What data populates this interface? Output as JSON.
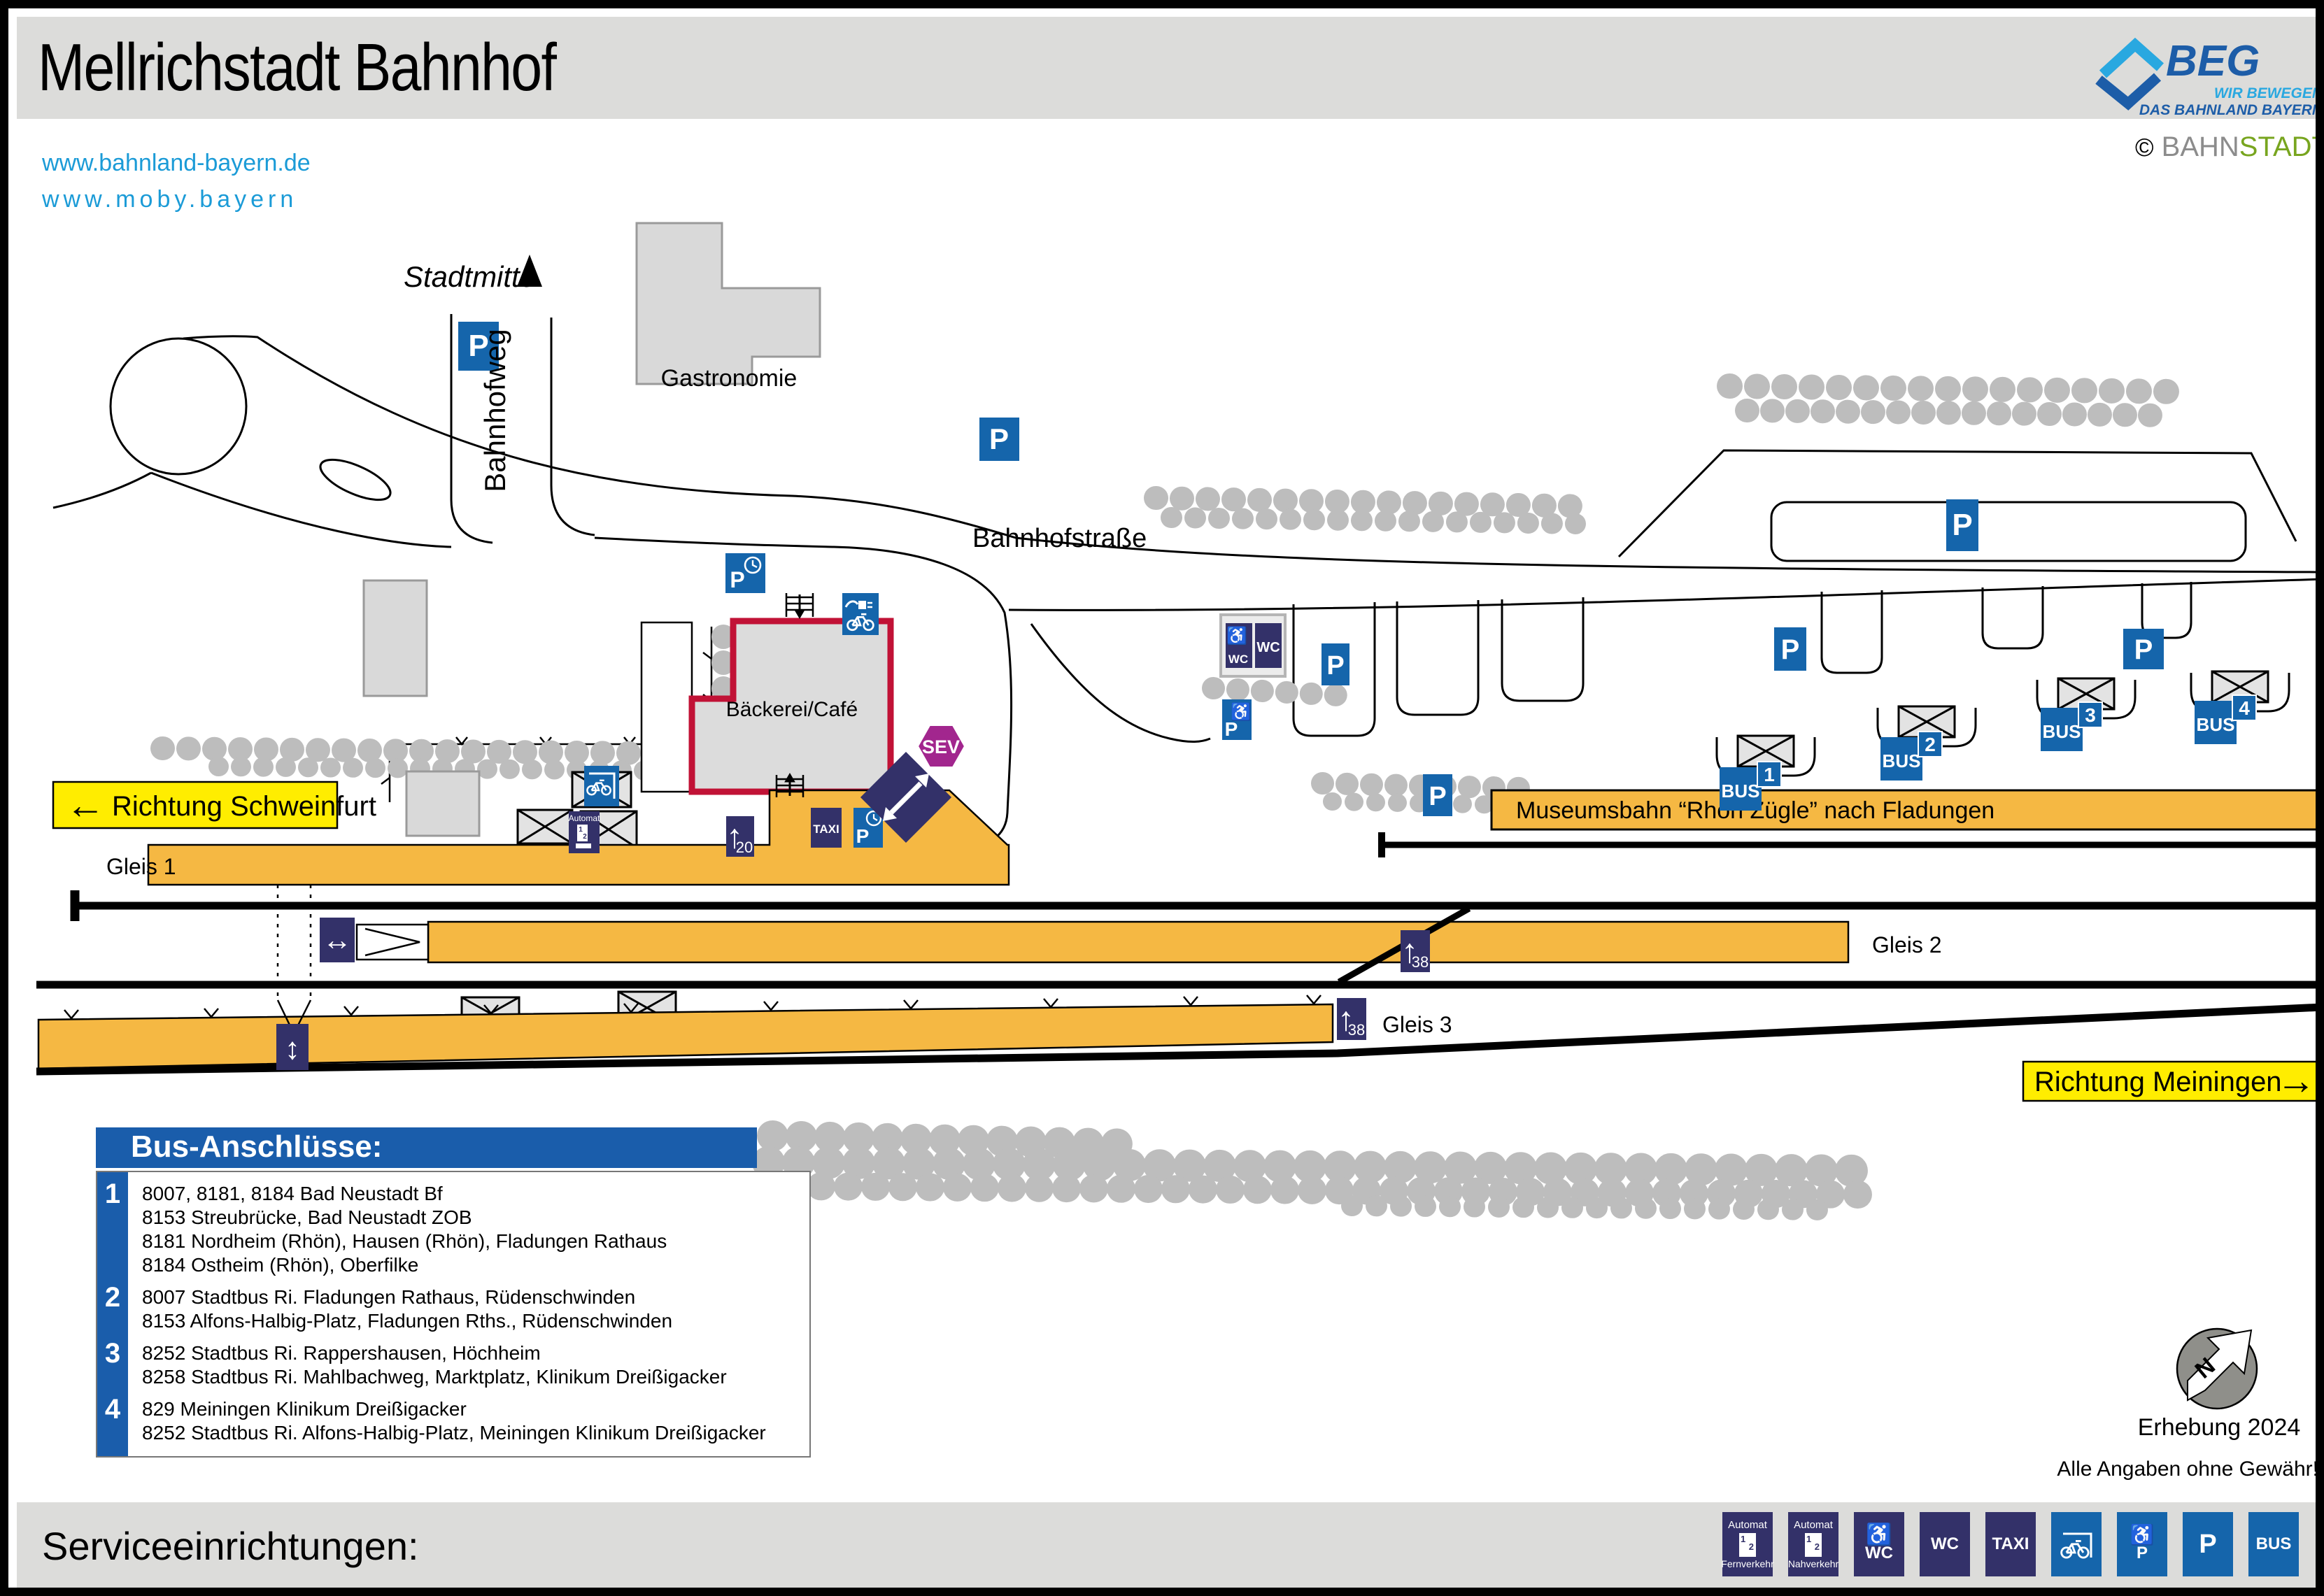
{
  "header": {
    "title": "Mellrichstadt Bahnhof",
    "links": [
      "www.bahnland-bayern.de",
      "www.moby.bayern"
    ],
    "beg": {
      "name": "BEG",
      "tagline1": "WIR BEWEGEN",
      "tagline2": "DAS BAHNLAND BAYERN"
    },
    "credit": {
      "copyright": "©",
      "part1": "BAHN",
      "part2": "STADT"
    }
  },
  "map": {
    "labels": {
      "stadtmitte": "Stadtmitte",
      "bahnhofweg": "Bahnhofweg",
      "bahnhofstrasse": "Bahnhofstraße",
      "gastronomie": "Gastronomie",
      "baeckerei": "Bäckerei/Café",
      "museumsbahn": "Museumsbahn “Rhön Zügle” nach Fladungen",
      "gleis1": "Gleis 1",
      "gleis2": "Gleis 2",
      "gleis3": "Gleis 3",
      "richtung_schweinfurt": "Richtung Schweinfurt",
      "richtung_meiningen": "Richtung Meiningen",
      "arrow_left": "←",
      "arrow_right": "→",
      "arrow_up": "↑",
      "arrow_lr": "↔",
      "arrow_ud": "↕"
    },
    "icons": {
      "p": "P",
      "wc": "WC",
      "taxi": "TAXI",
      "bus": "BUS",
      "sev": "SEV",
      "automat": "Automat",
      "wheelchair": "♿",
      "platform_height_20": "20",
      "platform_height_38": "38",
      "bus_stop_numbers": [
        "1",
        "2",
        "3",
        "4"
      ],
      "automat_slots": [
        "1",
        "2"
      ]
    },
    "notes": {
      "erhebung": "Erhebung 2024",
      "disclaimer": "Alle Angaben ohne Gewähr!",
      "compass_n": "N"
    },
    "colors": {
      "platform_orange": "#F5B843",
      "sign_navy": "#333169",
      "sign_blue": "#1565AB",
      "sev_magenta": "#A2268E",
      "direction_yellow": "#FFED00",
      "building_red": "#C11236",
      "link_blue": "#1B9BD7",
      "legend_blue": "#1A5DAB"
    }
  },
  "bus_legend": {
    "title": "Bus-Anschlüsse:",
    "rows": [
      {
        "stop": "1",
        "lines": [
          "8007, 8181, 8184 Bad Neustadt Bf",
          "8153 Streubrücke, Bad Neustadt ZOB",
          "8181 Nordheim (Rhön), Hausen (Rhön), Fladungen Rathaus",
          "8184 Ostheim (Rhön), Oberfilke"
        ]
      },
      {
        "stop": "2",
        "lines": [
          "8007 Stadtbus Ri. Fladungen Rathaus, Rüdenschwinden",
          "8153 Alfons-Halbig-Platz, Fladungen Rths., Rüdenschwinden"
        ]
      },
      {
        "stop": "3",
        "lines": [
          "8252 Stadtbus Ri. Rappershausen, Höchheim",
          "8258 Stadtbus Ri. Mahlbachweg, Marktplatz, Klinikum Dreißigacker"
        ]
      },
      {
        "stop": "4",
        "lines": [
          "829 Meiningen Klinikum Dreißigacker",
          "8252 Stadtbus Ri. Alfons-Halbig-Platz, Meiningen Klinikum Dreißigacker"
        ]
      }
    ]
  },
  "footer": {
    "title": "Serviceeinrichtungen:",
    "icons": [
      {
        "top": "Automat",
        "bottom": "Fernverkehr"
      },
      {
        "top": "Automat",
        "bottom": "Nahverkehr"
      },
      {
        "label": "WC"
      },
      {
        "label": "WC"
      },
      {
        "label": "TAXI"
      },
      {
        "label": ""
      },
      {
        "label": "P"
      },
      {
        "label": "P"
      },
      {
        "label": "BUS"
      }
    ]
  }
}
